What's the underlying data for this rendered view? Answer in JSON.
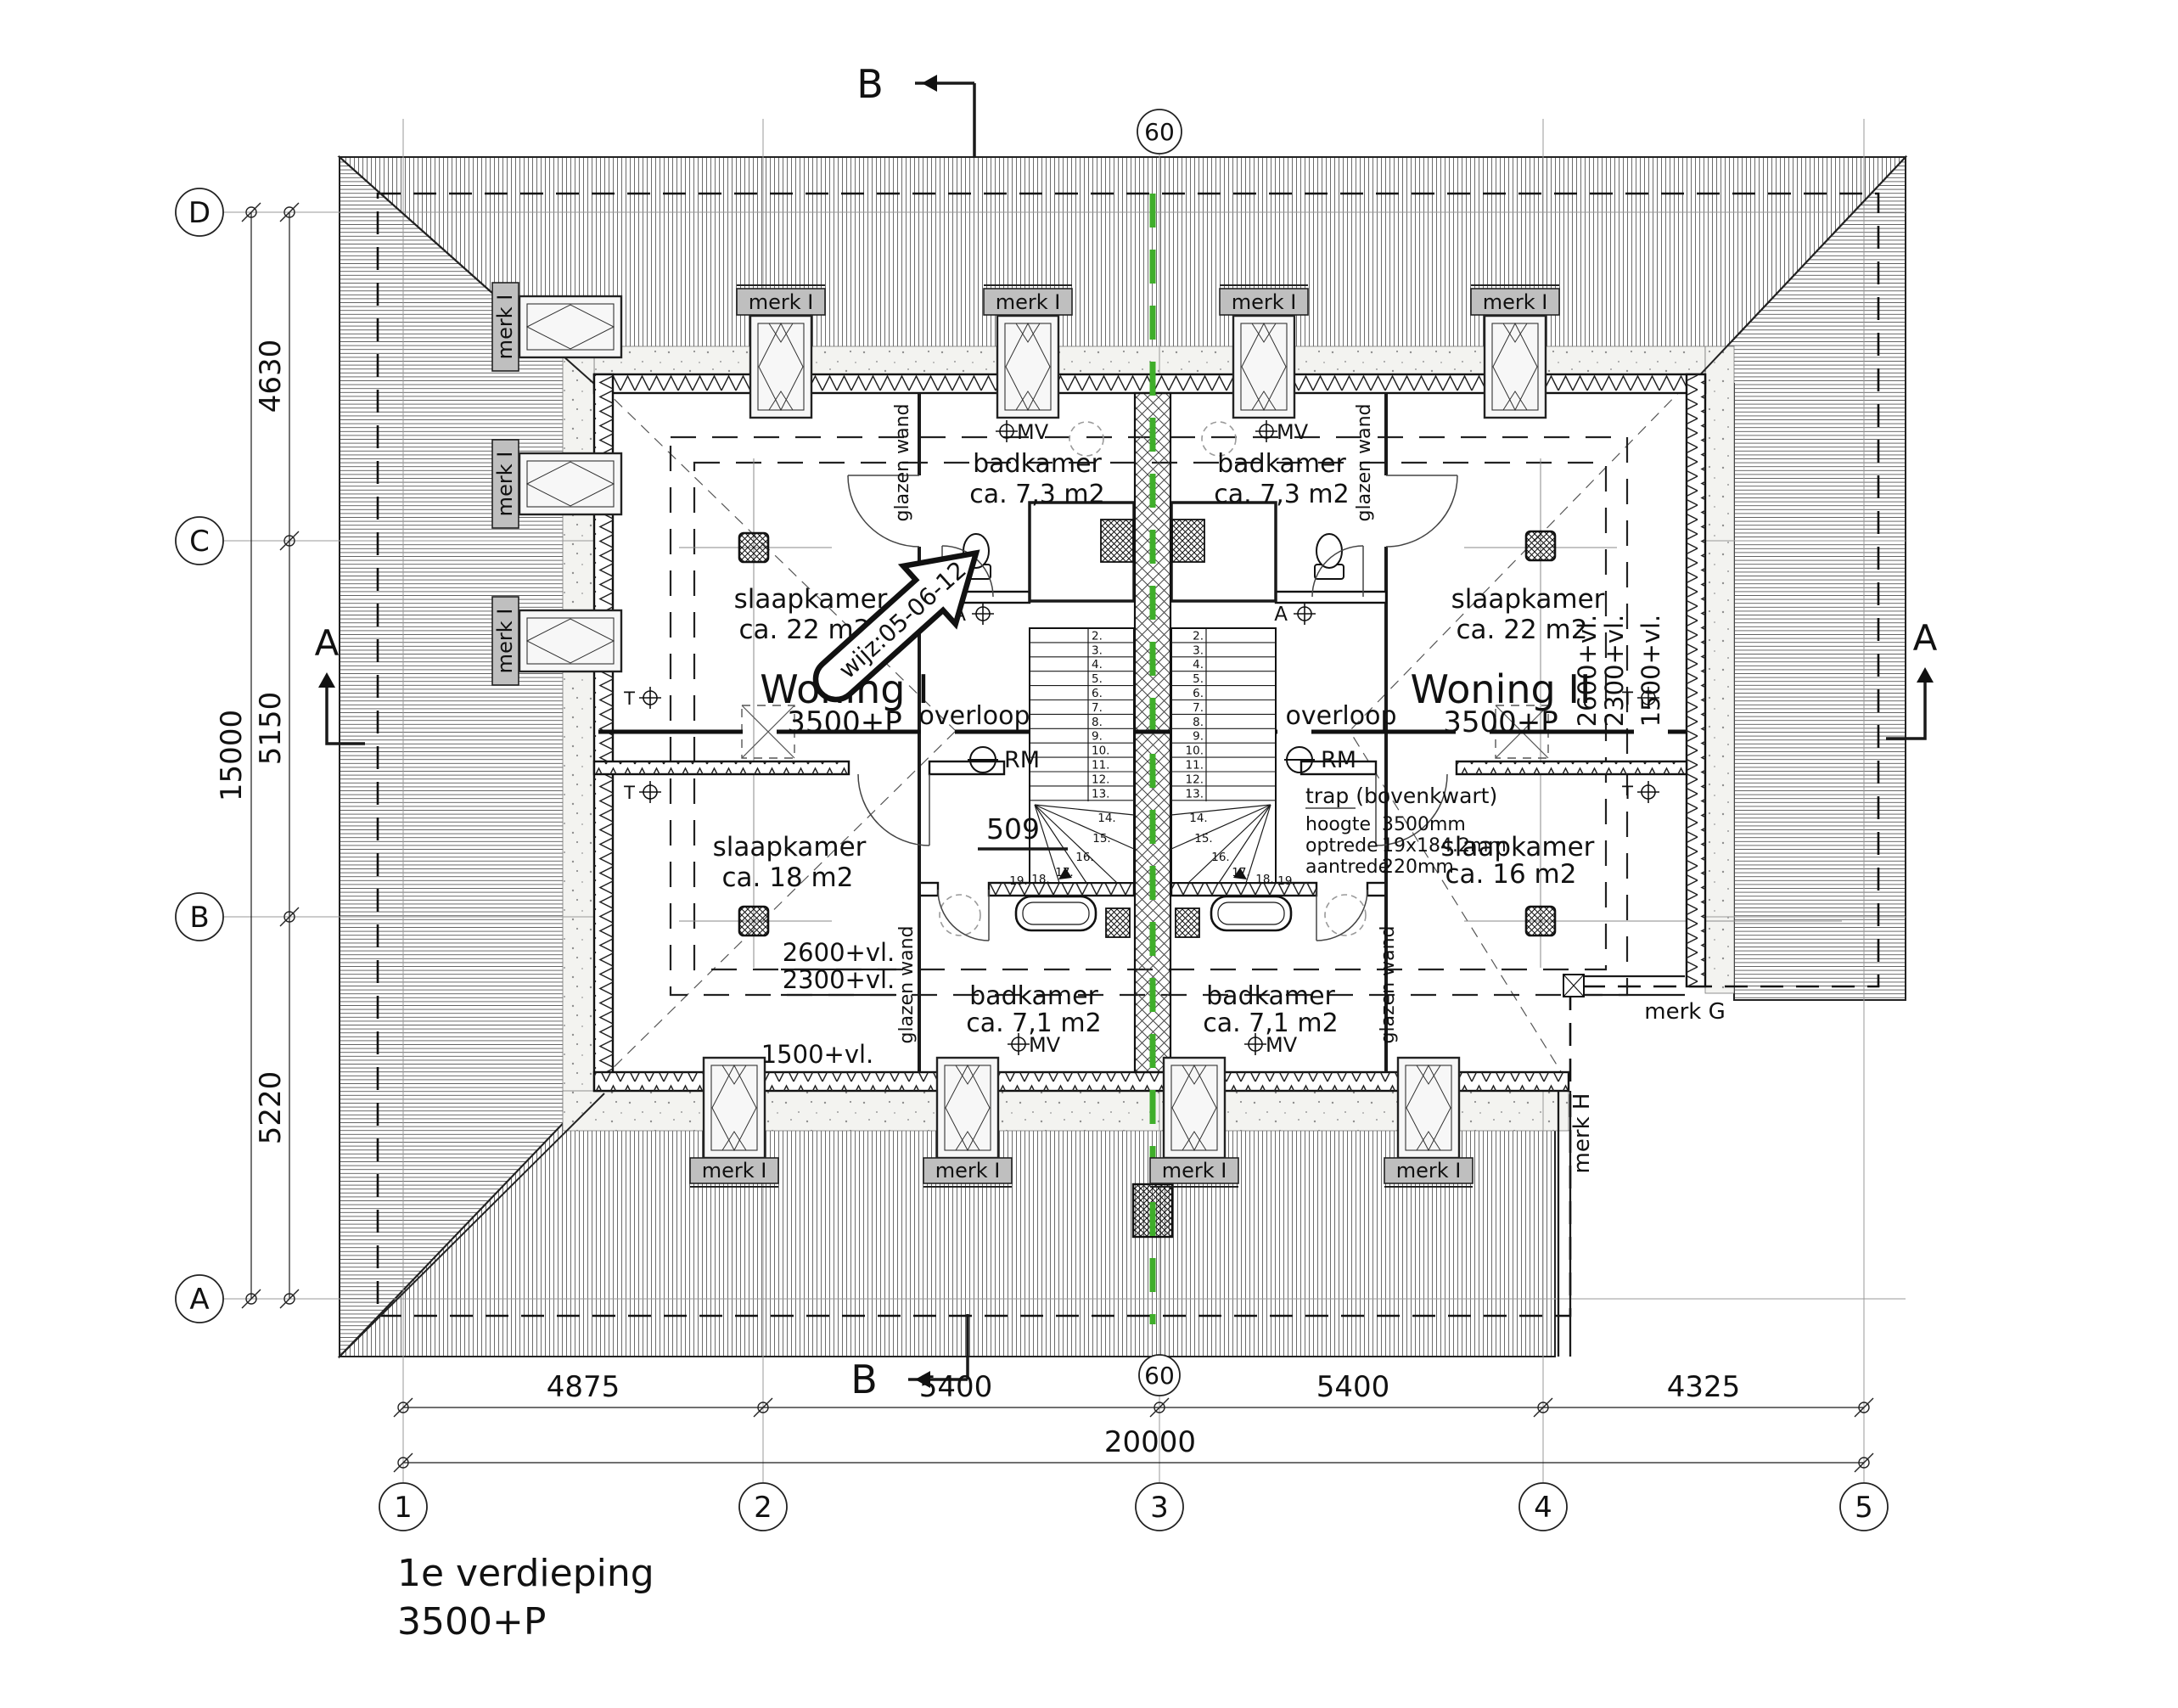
{
  "title": {
    "line1": "1e verdieping",
    "line2": "3500+P"
  },
  "units": {
    "left": {
      "name": "Woning I",
      "level": "3500+P"
    },
    "right": {
      "name": "Woning II",
      "level": "3500+P"
    }
  },
  "rooms": {
    "badkamer": "badkamer",
    "badkamer_top_area": "ca. 7,3 m2",
    "badkamer_bottom_area": "ca. 7,1 m2",
    "slaapkamer": "slaapkamer",
    "area_22": "ca. 22 m2",
    "area_18": "ca. 18 m2",
    "area_16": "ca. 16 m2",
    "overloop": "overloop"
  },
  "labels": {
    "glazen_wand": "glazen wand",
    "merk_i": "merk I",
    "merk_g": "merk G",
    "merk_h": "merk H",
    "mv": "MV",
    "rm": "RM",
    "t": "T",
    "a_symbol": "A",
    "ref_509": "509",
    "wijz": "wijz:05-06-12",
    "level_2600": "2600+vl.",
    "level_2300": "2300+vl.",
    "level_1500": "1500+vl."
  },
  "trap_note": {
    "title": "trap (bovenkwart)",
    "rows": [
      [
        "hoogte",
        "3500mm"
      ],
      [
        "optrede",
        "19x184.2mm"
      ],
      [
        "aantrede",
        "220mm"
      ]
    ]
  },
  "stairs": {
    "treads": [
      "2.",
      "3.",
      "4.",
      "5.",
      "6.",
      "7.",
      "8.",
      "9.",
      "10.",
      "11.",
      "12.",
      "13."
    ],
    "winders": [
      "14.",
      "15.",
      "16.",
      "17.",
      "18.",
      "19."
    ]
  },
  "grid": {
    "columns": [
      "1",
      "2",
      "3",
      "4",
      "5"
    ],
    "rows": [
      "D",
      "C",
      "B",
      "A"
    ],
    "offset": "60"
  },
  "dimensions": {
    "left": [
      "4630",
      "5150",
      "5220"
    ],
    "left_total": "15000",
    "bottom": [
      "4875",
      "5400",
      "5400",
      "4325"
    ],
    "bottom_total": "20000"
  },
  "sections": {
    "a": "A",
    "b": "B"
  },
  "colors": {
    "section_green": "#3fae2a",
    "line": "#1a1a1a",
    "hatch": "#5c5c5c",
    "merk_fill": "#bfbfbf"
  }
}
